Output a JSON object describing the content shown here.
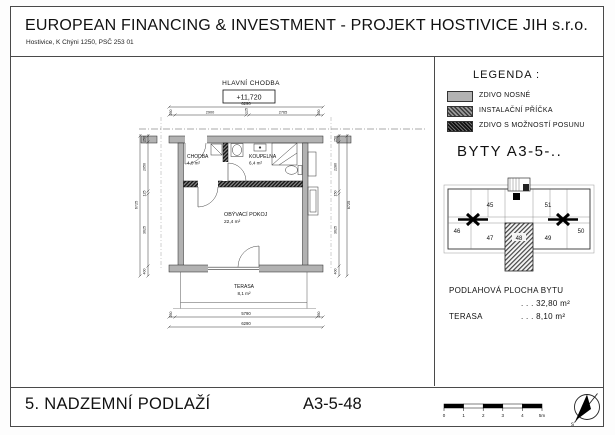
{
  "header": {
    "title": "EUROPEAN FINANCING & INVESTMENT - PROJEKT HOSTIVICE JIH s.r.o.",
    "address": "Hostivice, K Chýni 1250, PSČ 253 01"
  },
  "plan": {
    "corridor_label": "HLAVNÍ CHODBA",
    "level": "+11,720",
    "rooms": {
      "chodba": {
        "name": "CHODBA",
        "area": "4,0 m²"
      },
      "koupelna": {
        "name": "KOUPELNA",
        "area": "6,4 m²"
      },
      "obyvaci": {
        "name": "OBÝVACÍ POKOJ",
        "area": "22,4 m²"
      },
      "terasa": {
        "name": "TERASA",
        "area": "8,1 m²"
      }
    },
    "dims": {
      "top_total": "6290",
      "top": [
        "250",
        "2900",
        "125",
        "2765",
        "250"
      ],
      "bottom_inner": "5790",
      "bottom_end_left": "250",
      "bottom_end_right": "250",
      "bottom_total": "6290",
      "left_total": "6725",
      "left": [
        "250",
        "2050",
        "125",
        "3625",
        "400"
      ],
      "right_total": "6725",
      "right": [
        "250",
        "2280",
        "150",
        "3625",
        "400"
      ]
    }
  },
  "legend": {
    "title": "LEGENDA :",
    "items": [
      {
        "label": "ZDIVO NOSNÉ",
        "style": "solid-gray"
      },
      {
        "label": "INSTALAČNÍ PŘÍČKA",
        "style": "hatch-medium"
      },
      {
        "label": "ZDIVO S MOŽNOSTÍ POSUNU",
        "style": "hatch-dark"
      }
    ],
    "byty": "BYTY  A3-5-.."
  },
  "key_plan": {
    "units": [
      "45",
      "46",
      "47",
      "48",
      "49",
      "50",
      "51"
    ],
    "highlighted": "48"
  },
  "areas": {
    "floor_label": "PODLAHOVÁ PLOCHA BYTU",
    "floor_value": ". . .  32,80 m²",
    "terrace_label": "TERASA",
    "terrace_value": ". . .  8,10 m²"
  },
  "footer": {
    "floor": "5. NADZEMNÍ PODLAŽÍ",
    "unit": "A3-5-48",
    "scale": [
      "0",
      "1",
      "2",
      "3",
      "4",
      "5m"
    ],
    "north": "s"
  },
  "colors": {
    "wall": "#b2b2b2",
    "line": "#000000",
    "page_bg": "#ffffff"
  }
}
